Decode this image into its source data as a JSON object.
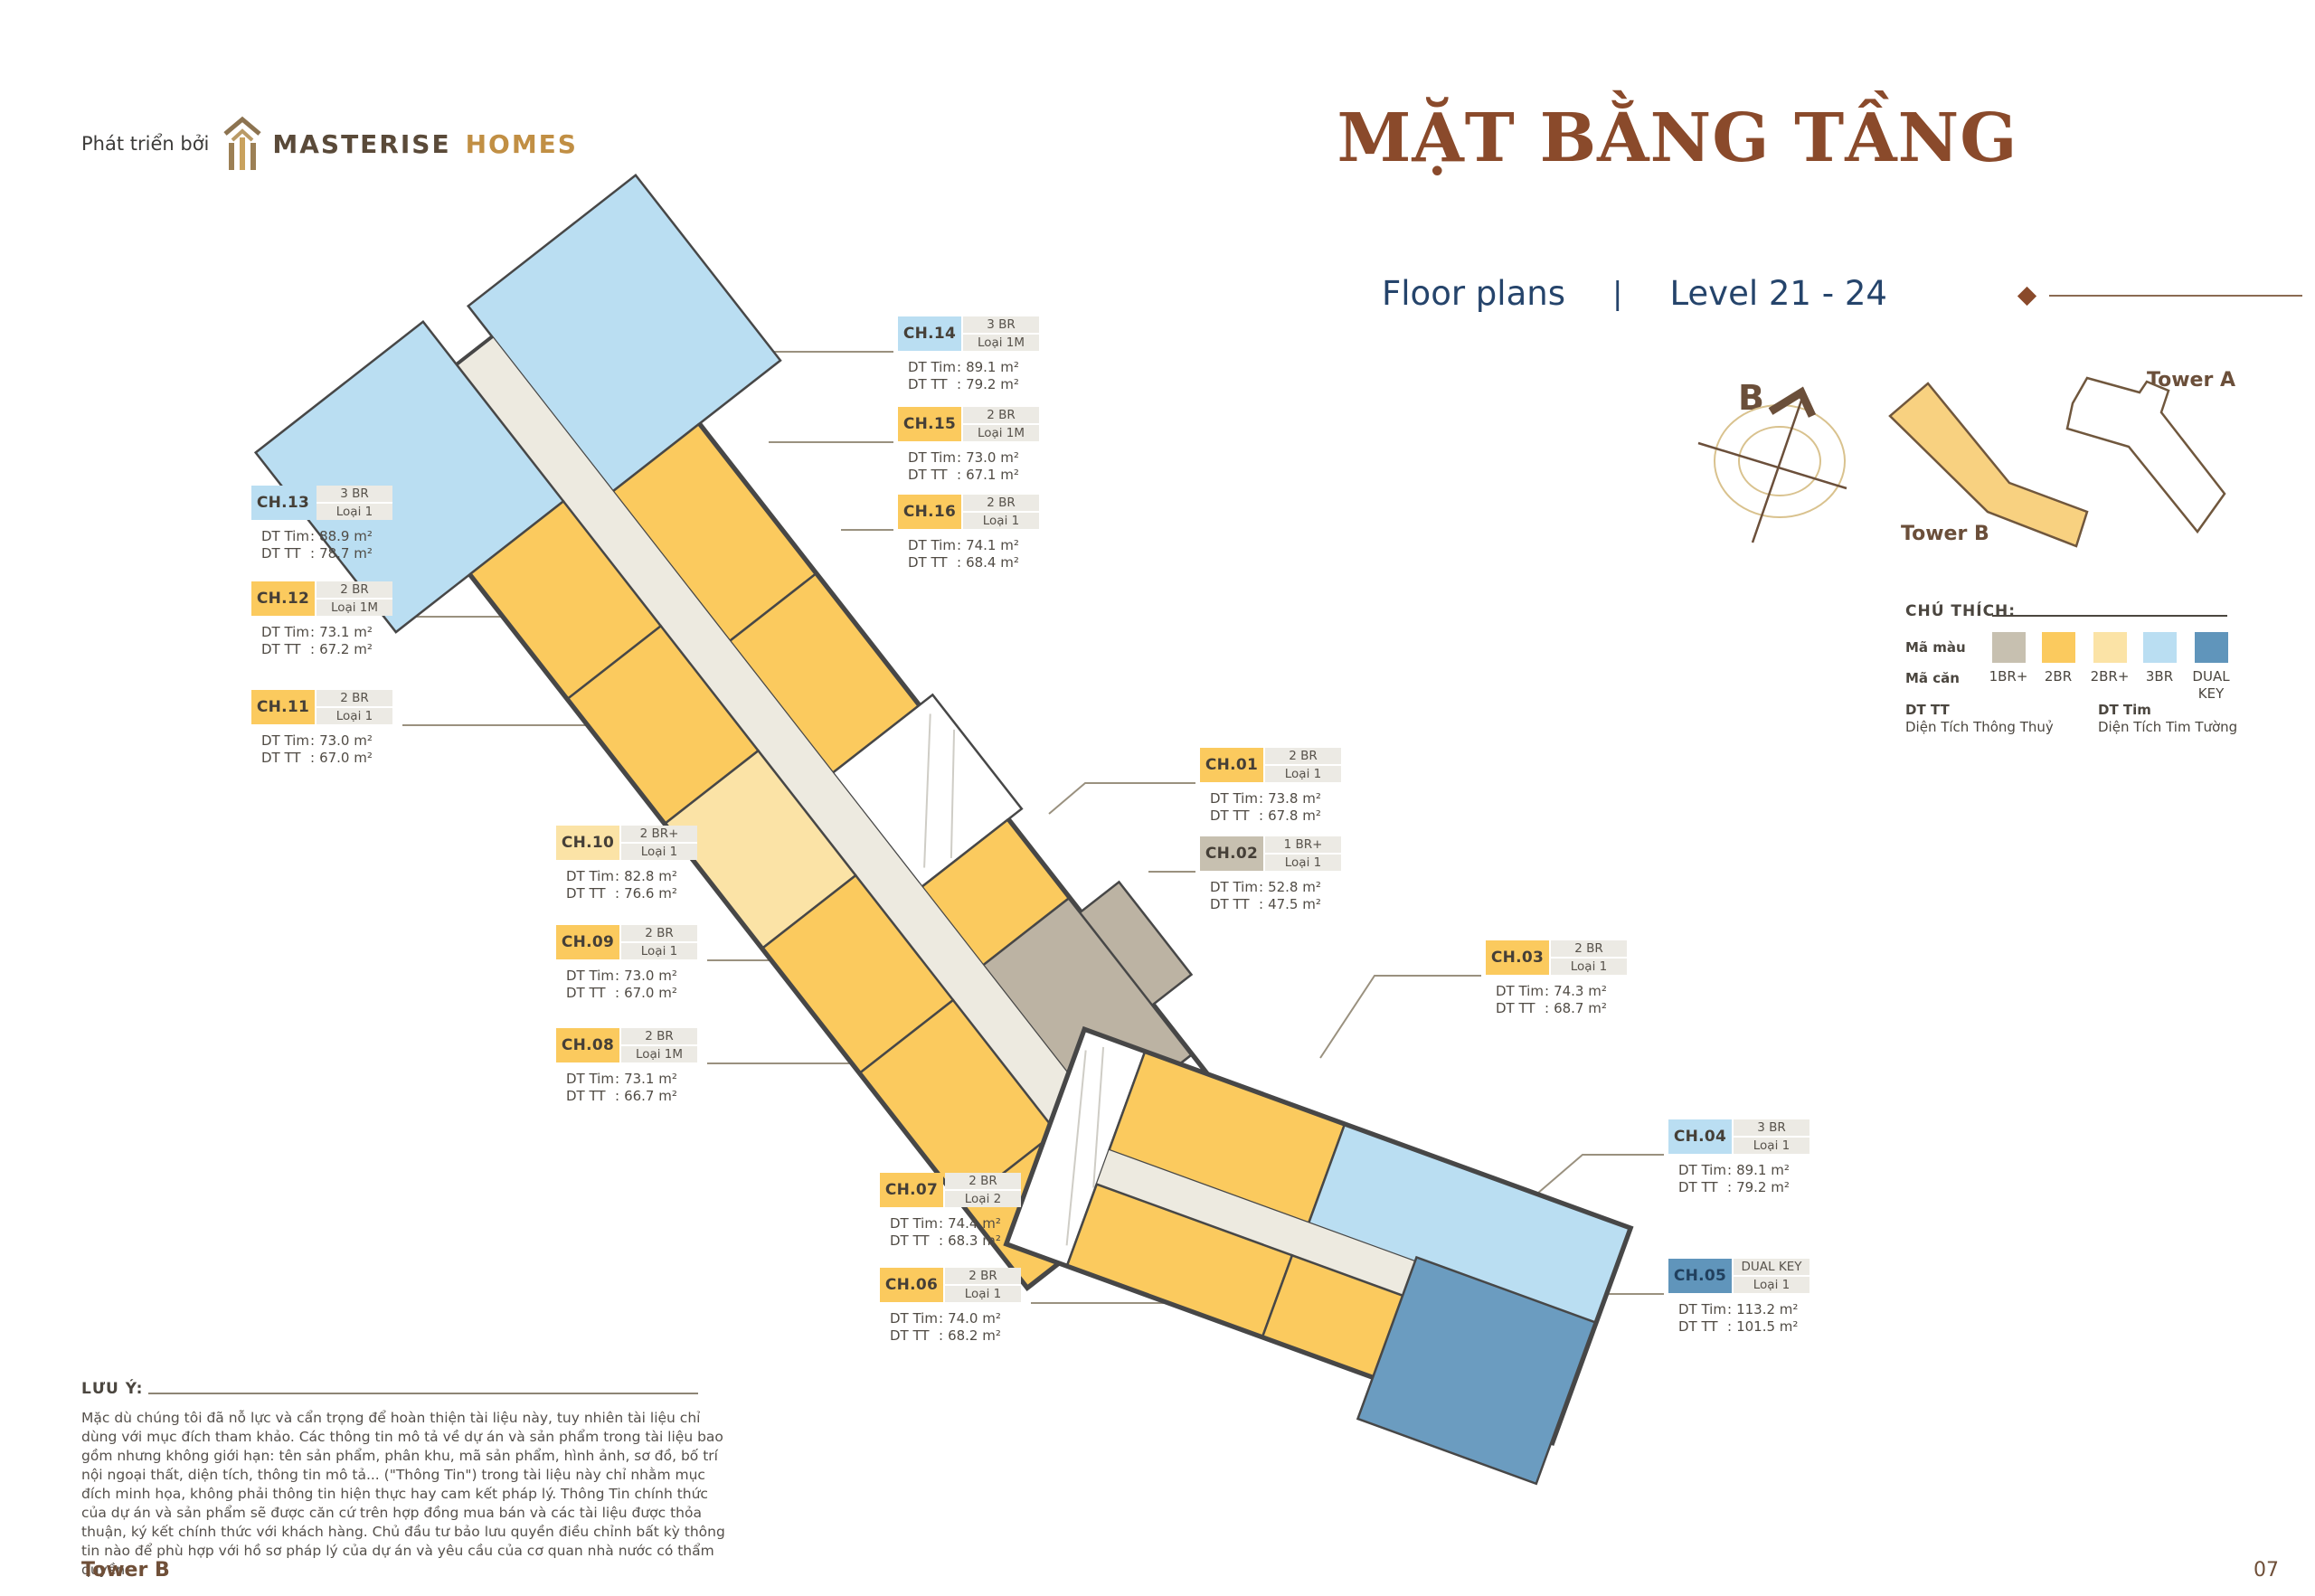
{
  "brand": {
    "prefix": "Phát triển bởi",
    "name": "MASTERISE",
    "suffix": "HOMES"
  },
  "header": {
    "title": "MẶT BẰNG TẦNG",
    "subtitle": "Floor plans",
    "divider": "|",
    "level": "Level 21 - 24"
  },
  "site_map": {
    "compass_letter": "B",
    "tower_a": "Tower A",
    "tower_b": "Tower B"
  },
  "legend": {
    "title": "CHÚ THÍCH:",
    "color_row_label": "Mã màu",
    "unit_row_label": "Mã căn",
    "types": [
      {
        "code": "1BR+",
        "color": "#c7c0b0"
      },
      {
        "code": "2BR",
        "color": "#fbca5e"
      },
      {
        "code": "2BR+",
        "color": "#fbe3a6"
      },
      {
        "code": "3BR",
        "color": "#badef2"
      },
      {
        "code": "DUAL\nKEY",
        "color": "#6095bb"
      }
    ],
    "dt_tt_abbr": "DT TT",
    "dt_tt_full": "Diện Tích Thông Thuỷ",
    "dt_tim_abbr": "DT Tim",
    "dt_tim_full": "Diện Tích Tim Tường"
  },
  "labels": {
    "dt_tim": "DT Tim",
    "dt_tt": "DT TT",
    "colon": ":"
  },
  "units": [
    {
      "code": "CH.01",
      "type": "2 BR",
      "variant": "Loại 1",
      "dt_tim": "73.8 m²",
      "dt_tt": "67.8 m²",
      "category": "2BR"
    },
    {
      "code": "CH.02",
      "type": "1 BR+",
      "variant": "Loại 1",
      "dt_tim": "52.8 m²",
      "dt_tt": "47.5 m²",
      "category": "1BR+"
    },
    {
      "code": "CH.03",
      "type": "2 BR",
      "variant": "Loại 1",
      "dt_tim": "74.3 m²",
      "dt_tt": "68.7 m²",
      "category": "2BR"
    },
    {
      "code": "CH.04",
      "type": "3 BR",
      "variant": "Loại 1",
      "dt_tim": "89.1 m²",
      "dt_tt": "79.2 m²",
      "category": "3BR"
    },
    {
      "code": "CH.05",
      "type": "DUAL KEY",
      "variant": "Loại 1",
      "dt_tim": "113.2 m²",
      "dt_tt": "101.5 m²",
      "category": "DUAL KEY"
    },
    {
      "code": "CH.06",
      "type": "2 BR",
      "variant": "Loại 1",
      "dt_tim": "74.0 m²",
      "dt_tt": "68.2 m²",
      "category": "2BR"
    },
    {
      "code": "CH.07",
      "type": "2 BR",
      "variant": "Loại 2",
      "dt_tim": "74.4 m²",
      "dt_tt": "68.3 m²",
      "category": "2BR"
    },
    {
      "code": "CH.08",
      "type": "2 BR",
      "variant": "Loại 1M",
      "dt_tim": "73.1 m²",
      "dt_tt": "66.7 m²",
      "category": "2BR"
    },
    {
      "code": "CH.09",
      "type": "2 BR",
      "variant": "Loại 1",
      "dt_tim": "73.0 m²",
      "dt_tt": "67.0 m²",
      "category": "2BR"
    },
    {
      "code": "CH.10",
      "type": "2 BR+",
      "variant": "Loại 1",
      "dt_tim": "82.8 m²",
      "dt_tt": "76.6 m²",
      "category": "2BR+"
    },
    {
      "code": "CH.11",
      "type": "2 BR",
      "variant": "Loại 1",
      "dt_tim": "73.0 m²",
      "dt_tt": "67.0 m²",
      "category": "2BR"
    },
    {
      "code": "CH.12",
      "type": "2 BR",
      "variant": "Loại 1M",
      "dt_tim": "73.1 m²",
      "dt_tt": "67.2 m²",
      "category": "2BR"
    },
    {
      "code": "CH.13",
      "type": "3 BR",
      "variant": "Loại 1",
      "dt_tim": "88.9 m²",
      "dt_tt": "78.7 m²",
      "category": "3BR"
    },
    {
      "code": "CH.14",
      "type": "3 BR",
      "variant": "Loại 1M",
      "dt_tim": "89.1 m²",
      "dt_tt": "79.2 m²",
      "category": "3BR"
    },
    {
      "code": "CH.15",
      "type": "2 BR",
      "variant": "Loại 1M",
      "dt_tim": "73.0 m²",
      "dt_tt": "67.1 m²",
      "category": "2BR"
    },
    {
      "code": "CH.16",
      "type": "2 BR",
      "variant": "Loại 1",
      "dt_tim": "74.1 m²",
      "dt_tt": "68.4 m²",
      "category": "2BR"
    }
  ],
  "note": {
    "label": "LƯU Ý:",
    "text": "Mặc dù chúng tôi đã nỗ lực và cẩn trọng để hoàn thiện tài liệu này, tuy nhiên tài liệu chỉ dùng với mục đích tham khảo. Các thông tin mô tả về dự án và sản phẩm trong tài liệu bao gồm nhưng không giới hạn: tên sản phẩm, phân khu, mã sản phẩm, hình ảnh, sơ đồ, bố trí nội ngoại thất, diện tích, thông tin mô tả... (\"Thông Tin\") trong tài liệu này chỉ nhằm mục đích minh họa, không phải thông tin hiện thực hay cam kết pháp lý. Thông Tin chính thức của dự án và sản phẩm sẽ được căn cứ trên hợp đồng mua bán và các tài liệu được thỏa thuận, ký kết chính thức với khách hàng. Chủ đầu tư bảo lưu quyền điều chỉnh bất kỳ thông tin nào để phù hợp với hồ sơ pháp lý của dự án và yêu cầu của cơ quan nhà nước có thẩm quyền."
  },
  "footer": {
    "tower": "Tower B",
    "page": "07"
  }
}
